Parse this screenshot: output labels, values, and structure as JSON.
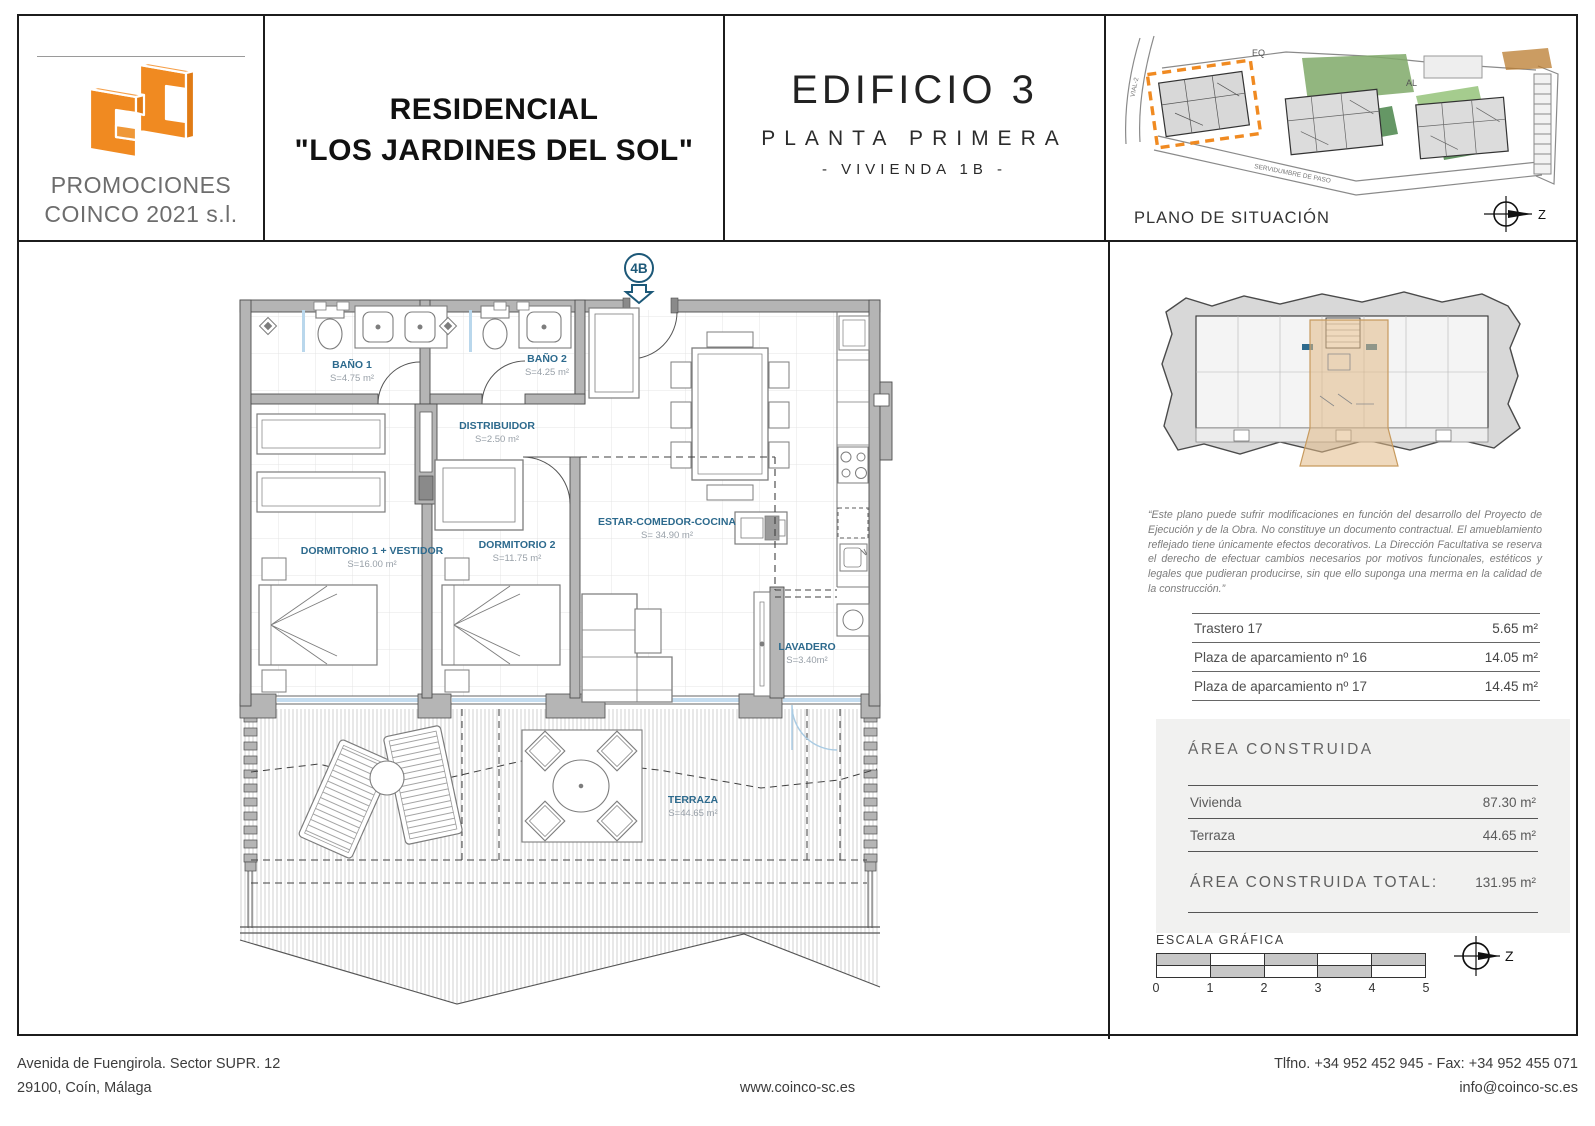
{
  "header": {
    "company_line1": "PROMOCIONES",
    "company_line2": "COINCO 2021 s.l.",
    "project_title_line1": "RESIDENCIAL",
    "project_title_line2": "\"LOS JARDINES DEL SOL\"",
    "building": "EDIFICIO 3",
    "floor": "PLANTA PRIMERA",
    "unit": "- VIVIENDA  1B -",
    "site_plan_label": "PLANO DE SITUACIÓN",
    "site_label_eq": "EQ",
    "site_label_al": "AL",
    "site_label_vial": "VIAL-2",
    "site_label_easement": "SERVIDUMBRE DE PASO",
    "compass_label": "Z"
  },
  "plan": {
    "unit_marker": "4B",
    "rooms": [
      {
        "name": "BAÑO 1",
        "area": "S=4.75 m²"
      },
      {
        "name": "BAÑO 2",
        "area": "S=4.25 m²"
      },
      {
        "name": "DISTRIBUIDOR",
        "area": "S=2.50 m²"
      },
      {
        "name": "DORMITORIO 1 + VESTIDOR",
        "area": "S=16.00 m²"
      },
      {
        "name": "DORMITORIO 2",
        "area": "S=11.75 m²"
      },
      {
        "name": "ESTAR-COMEDOR-COCINA",
        "area": "S= 34.90 m²"
      },
      {
        "name": "LAVADERO",
        "area": "S=3.40m²"
      },
      {
        "name": "TERRAZA",
        "area": "S=44.65 m²"
      }
    ]
  },
  "sidebar": {
    "disclaimer": "“Este plano puede sufrir modificaciones en función del desarrollo del Proyecto de Ejecución y de la Obra. No constituye un documento contractual. El amueblamiento reflejado tiene únicamente efectos decorativos. La Dirección Facultativa se reserva el derecho de efectuar cambios necesarios por motivos funcionales, estéticos y legales que pudieran producirse, sin que ello suponga una merma en la calidad de la construcción.”",
    "storage_rows": [
      {
        "label": "Trastero 17",
        "value": "5.65 m²"
      },
      {
        "label": "Plaza de aparcamiento  nº 16",
        "value": "14.05 m²"
      },
      {
        "label": "Plaza de aparcamiento  nº 17",
        "value": "14.45 m²"
      }
    ],
    "built_area": {
      "title": "ÁREA CONSTRUIDA",
      "rows": [
        {
          "label": "Vivienda",
          "value": "87.30 m²"
        },
        {
          "label": "Terraza",
          "value": "44.65 m²"
        }
      ],
      "total_label": "ÁREA CONSTRUIDA TOTAL:",
      "total_value": "131.95 m²"
    },
    "scale": {
      "label": "ESCALA GRÁFICA",
      "ticks": [
        "0",
        "1",
        "2",
        "3",
        "4",
        "5"
      ]
    },
    "compass_label": "Z"
  },
  "footer": {
    "address_line1": "Avenida de Fuengirola. Sector SUPR. 12",
    "address_line2": "29100, Coín, Málaga",
    "website": "www.coinco-sc.es",
    "phone": "Tlfno. +34 952 452 945 - Fax: +34 952 455 071",
    "email": "info@coinco-sc.es"
  },
  "colors": {
    "brand_orange": "#F08A21",
    "label_blue": "#2D6A8D",
    "marker_teal": "#1C5878",
    "wall_gray": "#B5B5B5",
    "highlight_tan": "#E2BA86"
  }
}
